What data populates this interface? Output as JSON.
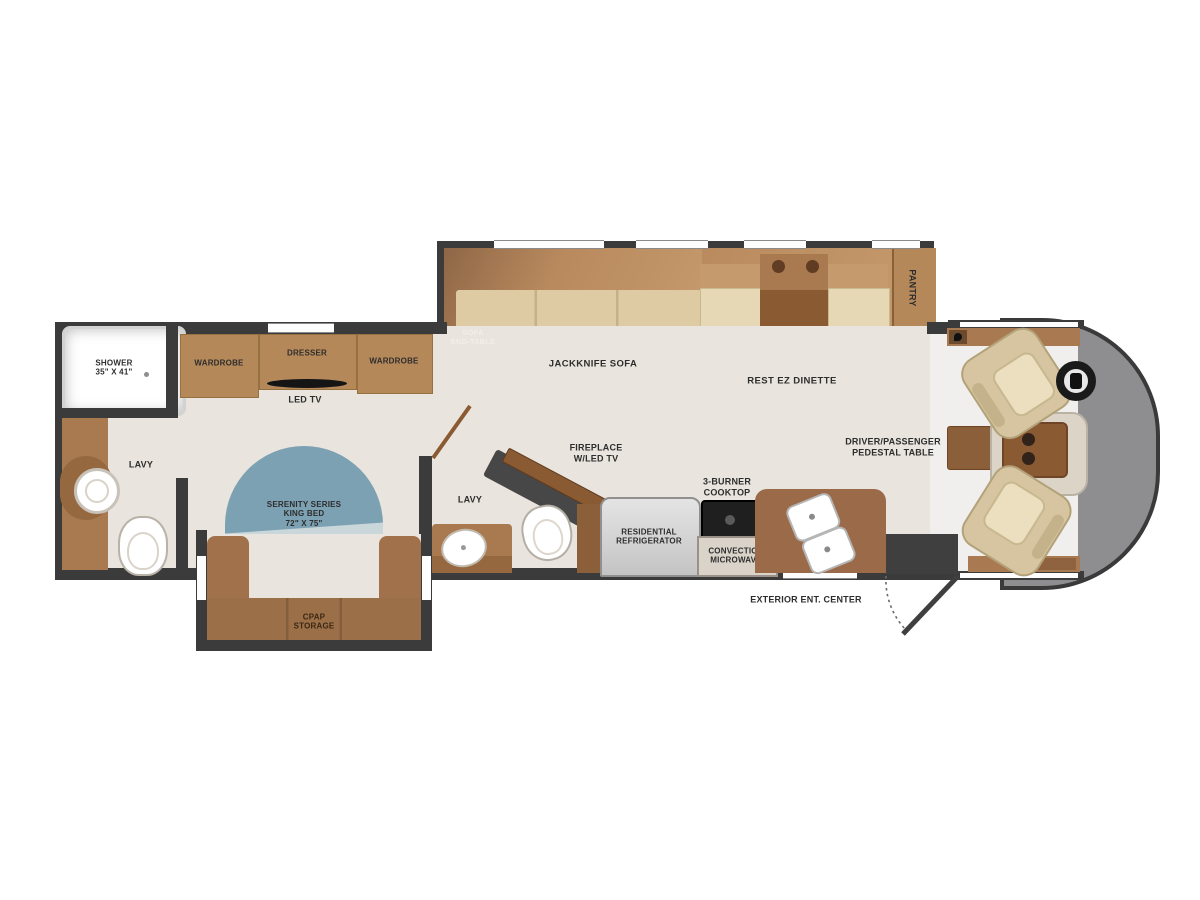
{
  "title": "RV floor plan",
  "colors": {
    "floor": "#e9e5de",
    "wall": "#3b3b3b",
    "cabinet": "#b58859",
    "counter": "#9b6b49",
    "dark_wood": "#8a5a33",
    "sofa_seat": "#decba4",
    "sofa_back": "#b8895d",
    "bed_blue": "#7ba1b2",
    "bed_blue_light": "#a3bec8",
    "nose_gray": "#8e8e91",
    "seat_tan": "#d6c5a0",
    "appliance_gray": "#d2d2d2",
    "cooktop_black": "#1f1f1f"
  },
  "rooms": {
    "bedroom": {
      "shower": "SHOWER\n35\" X 41\"",
      "wardrobe_left": "WARDROBE",
      "dresser": "DRESSER",
      "wardrobe_right": "WARDROBE",
      "led_tv": "LED TV",
      "lavy": "LAVY",
      "bed": "SERENITY SERIES\nKING BED\n72\" X 75\"",
      "cpap": "CPAP\nSTORAGE"
    },
    "living": {
      "sofa_end_table": "SOFA\nEND-TABLE",
      "jackknife_sofa": "JACKKNIFE SOFA",
      "dinette": "REST EZ DINETTE",
      "pantry": "PANTRY"
    },
    "mid_bath": {
      "lavy": "LAVY",
      "fireplace": "FIREPLACE\nW/LED TV"
    },
    "kitchen": {
      "refrigerator": "RESIDENTIAL\nREFRIGERATOR",
      "cooktop": "3-BURNER\nCOOKTOP",
      "microwave": "CONVECTION\nMICROWAVE",
      "exterior_ent_center": "EXTERIOR ENT. CENTER"
    },
    "cab": {
      "pedestal_table": "DRIVER/PASSENGER\nPEDESTAL TABLE"
    }
  }
}
